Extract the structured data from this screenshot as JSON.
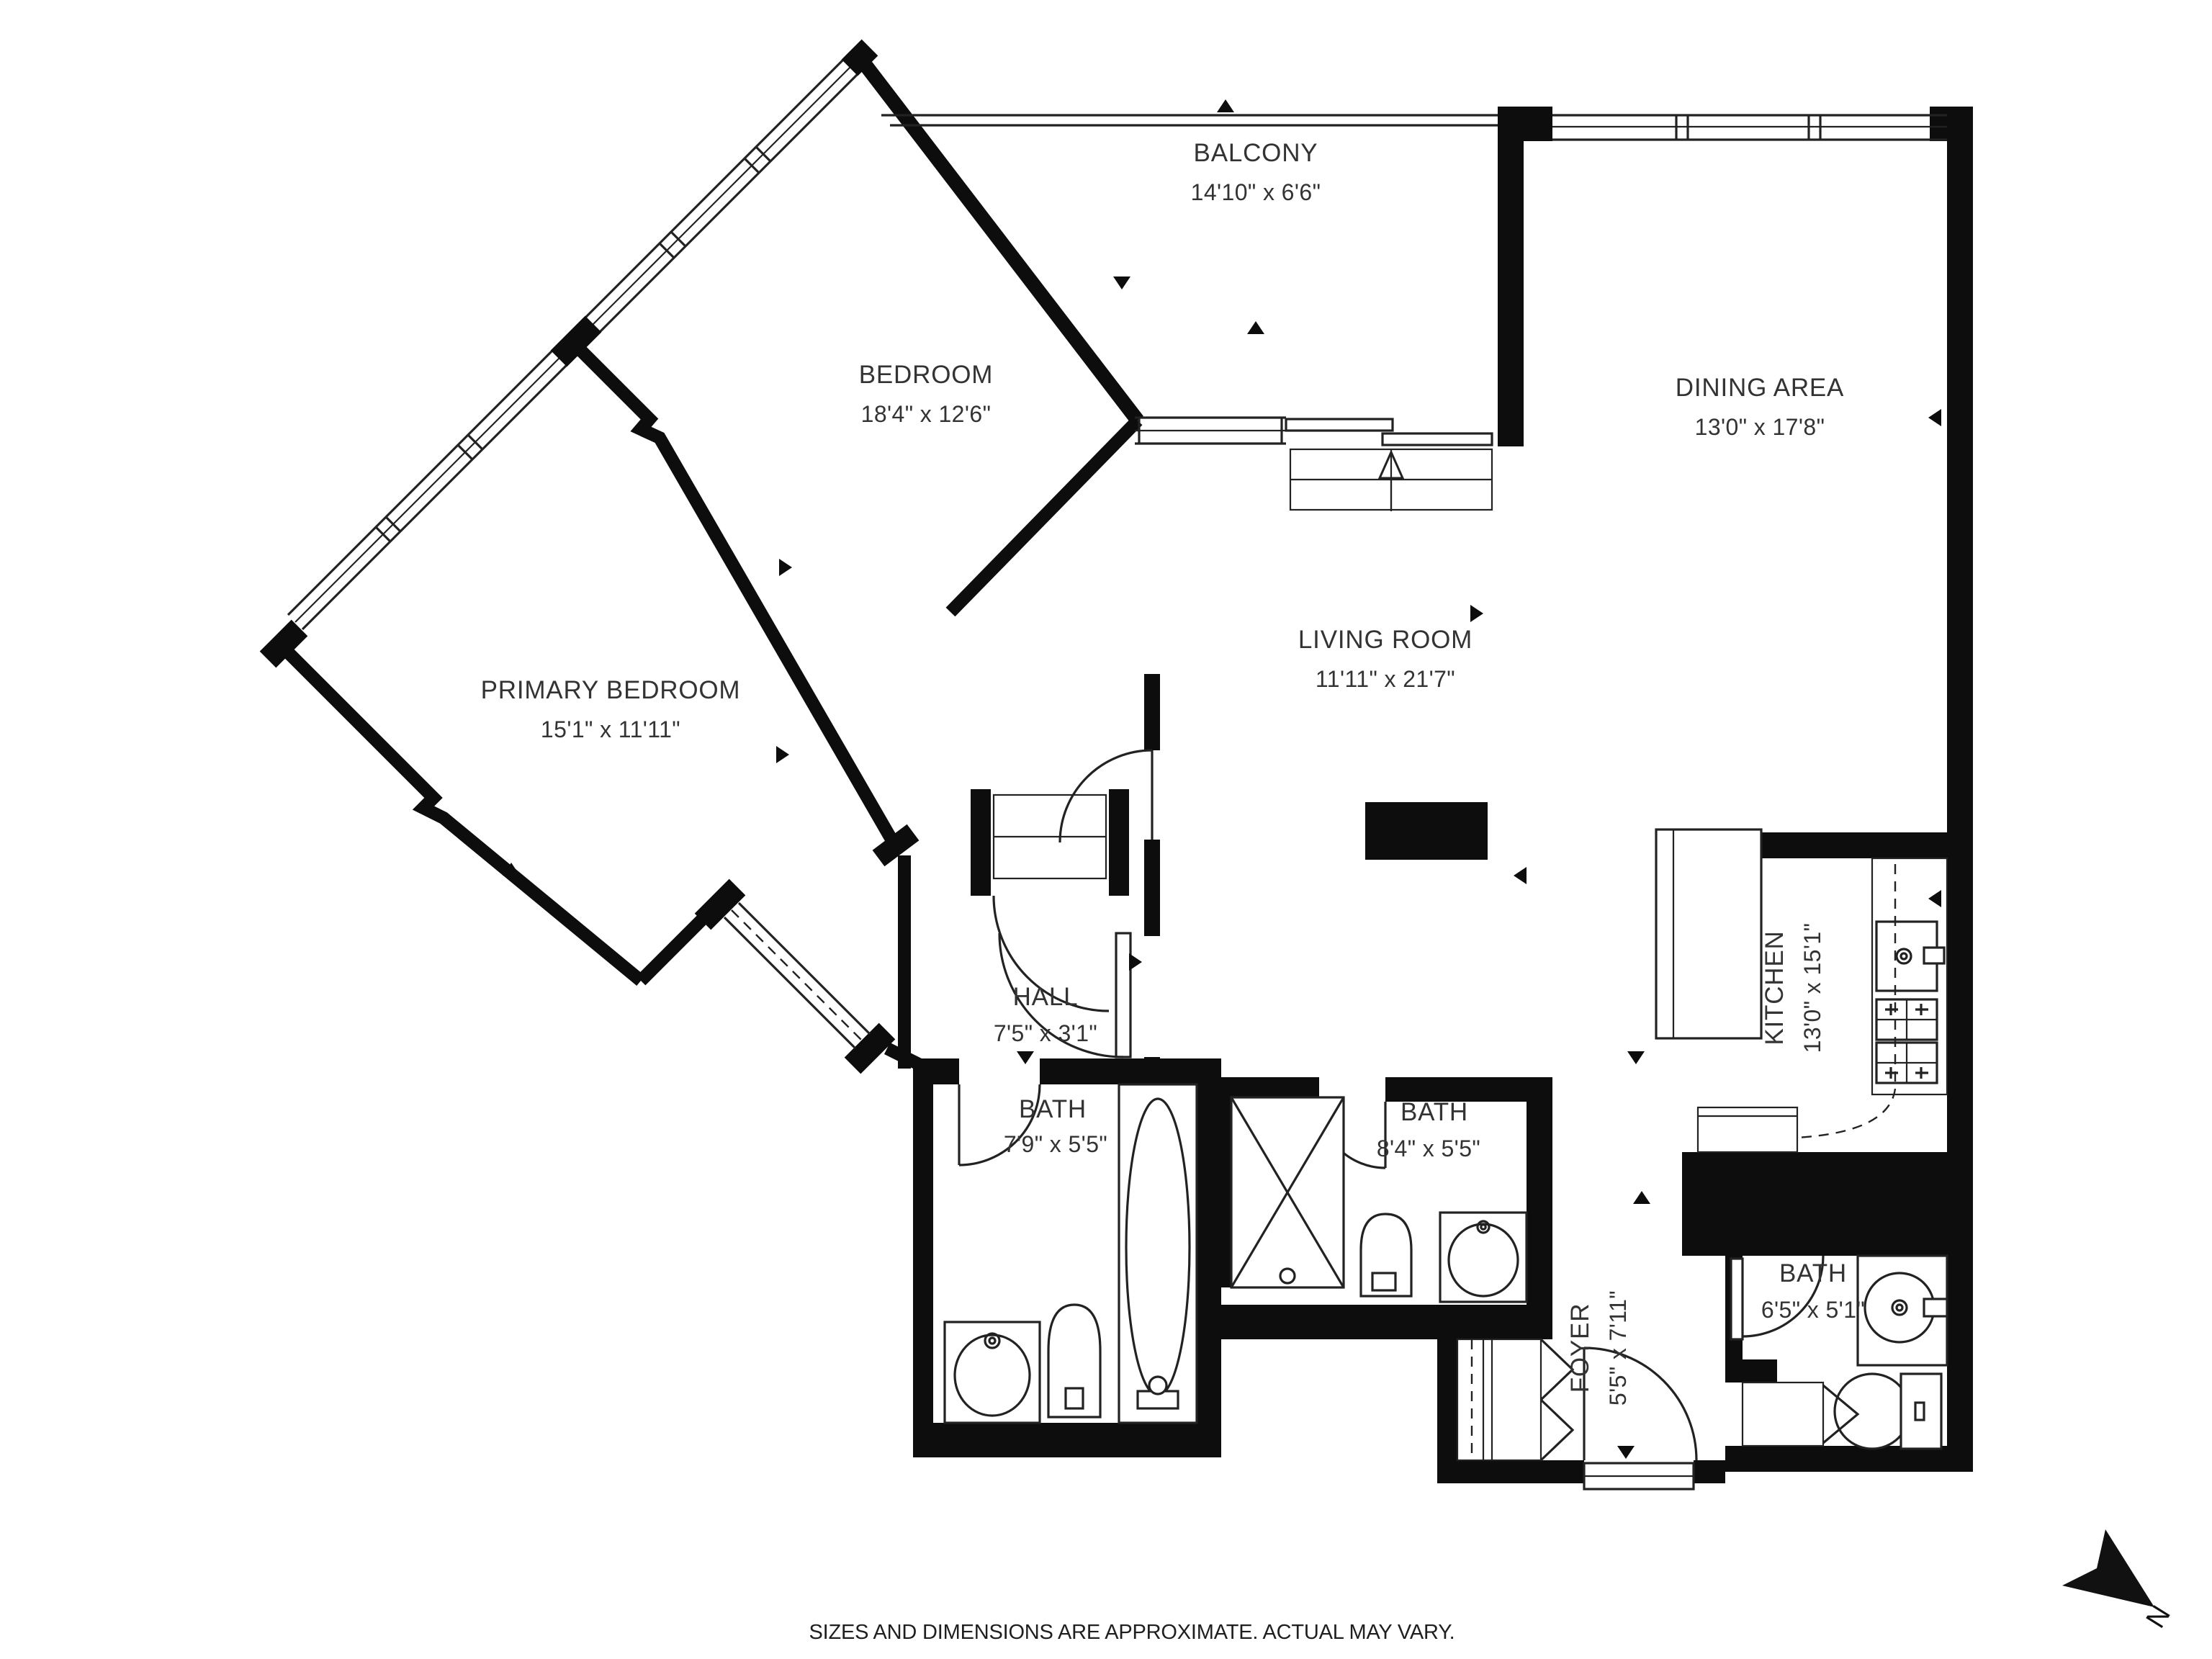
{
  "colors": {
    "wall": "#0d0d0d",
    "line": "#222222",
    "text": "#333333",
    "background": "#ffffff"
  },
  "rooms": {
    "balcony": {
      "name": "BALCONY",
      "dims": "14'10\" x 6'6\""
    },
    "bedroom": {
      "name": "BEDROOM",
      "dims": "18'4\" x 12'6\""
    },
    "dining": {
      "name": "DINING AREA",
      "dims": "13'0\" x 17'8\""
    },
    "primary": {
      "name": "PRIMARY BEDROOM",
      "dims": "15'1\" x 11'11\""
    },
    "living": {
      "name": "LIVING ROOM",
      "dims": "11'11\" x 21'7\""
    },
    "kitchen": {
      "name": "KITCHEN",
      "dims": "13'0\" x 15'1\""
    },
    "hall": {
      "name": "HALL",
      "dims": "7'5\" x 3'1\""
    },
    "bath1": {
      "name": "BATH",
      "dims": "7'9\" x 5'5\""
    },
    "bath2": {
      "name": "BATH",
      "dims": "8'4\" x 5'5\""
    },
    "bath3": {
      "name": "BATH",
      "dims": "6'5\" x 5'1\""
    },
    "foyer": {
      "name": "FOYER",
      "dims": "5'5\" x 7'11\""
    }
  },
  "footer": {
    "disclaimer": "SIZES AND DIMENSIONS ARE APPROXIMATE. ACTUAL MAY VARY."
  },
  "compass": {
    "north_label": "N"
  }
}
